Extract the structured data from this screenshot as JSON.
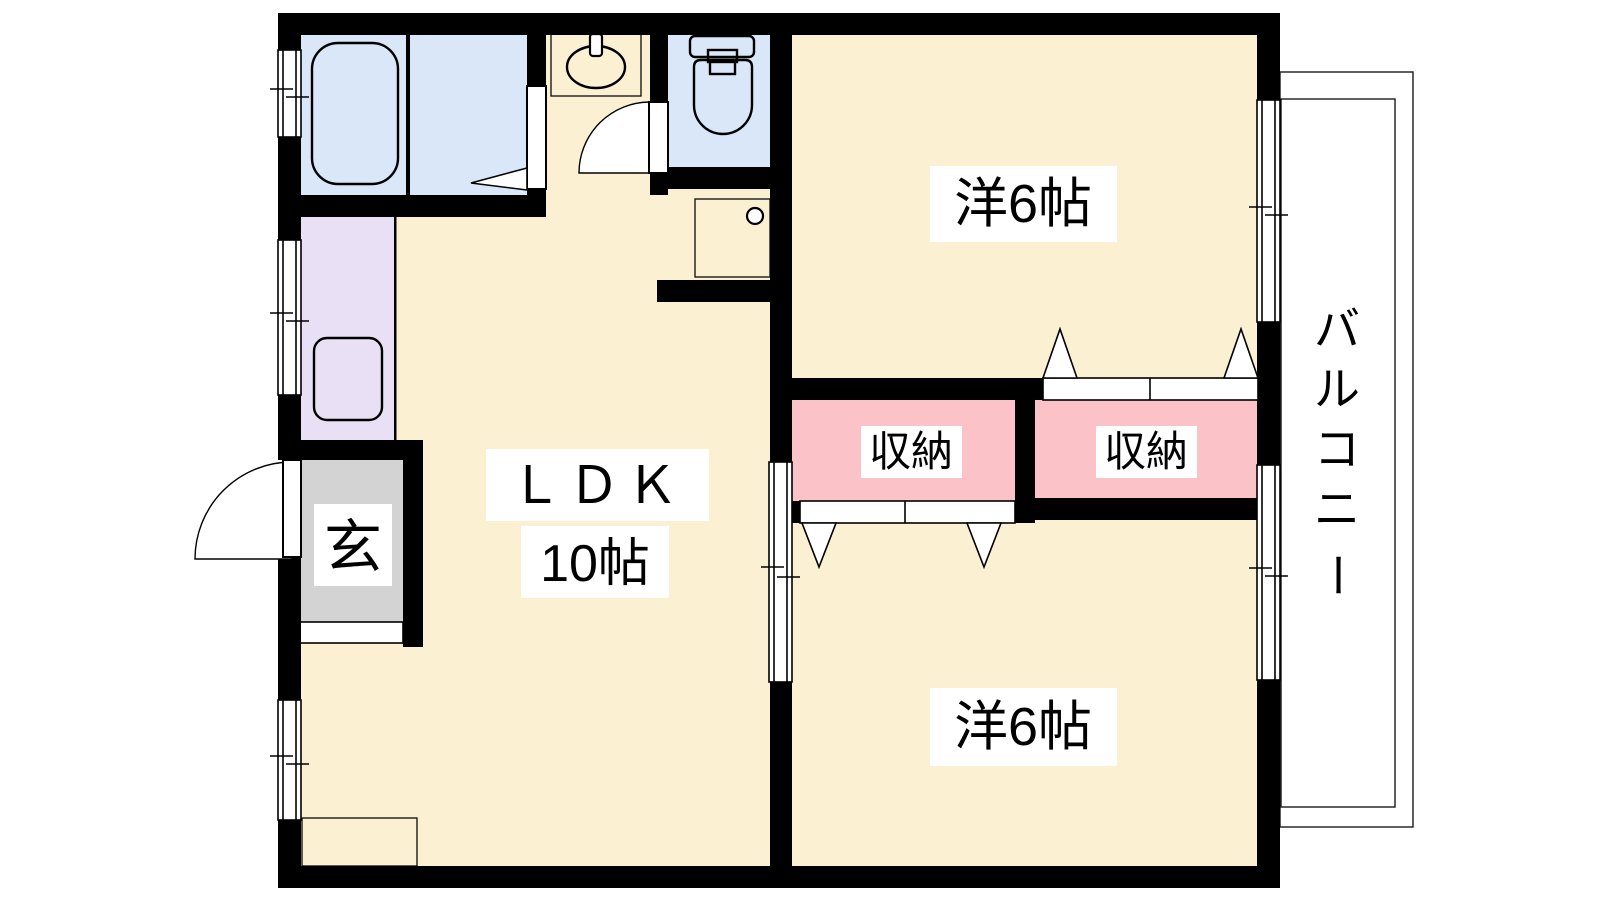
{
  "palette": {
    "wall": "#000000",
    "floor": "#FCF0D3",
    "wet_area": "#D9E7F9",
    "kitchen": "#E9E0F5",
    "closet": "#FBC3C8",
    "entrance": "#D3D3D3",
    "balcony": "#D3D3D3",
    "step": "#EADDC3",
    "label_bg": "#FFFFFF"
  },
  "rooms": {
    "western_top": {
      "label": "洋6帖"
    },
    "western_bottom": {
      "label": "洋6帖"
    },
    "ldk": {
      "label": "ＬＤＫ",
      "size": "10帖"
    },
    "closet_left": {
      "label": "収納"
    },
    "closet_right": {
      "label": "収納"
    },
    "entrance": {
      "label": "玄"
    },
    "balcony": {
      "label": "バルコニー",
      "chars": [
        "バ",
        "ル",
        "コ",
        "ニ",
        "ー"
      ]
    }
  },
  "fixtures": {
    "bathtub": "bathtub-icon",
    "washbasin": "washbasin-icon",
    "toilet": "toilet-icon",
    "washer_pan": "washing-machine-pan-icon",
    "kitchen_sink": "kitchen-sink-icon"
  }
}
